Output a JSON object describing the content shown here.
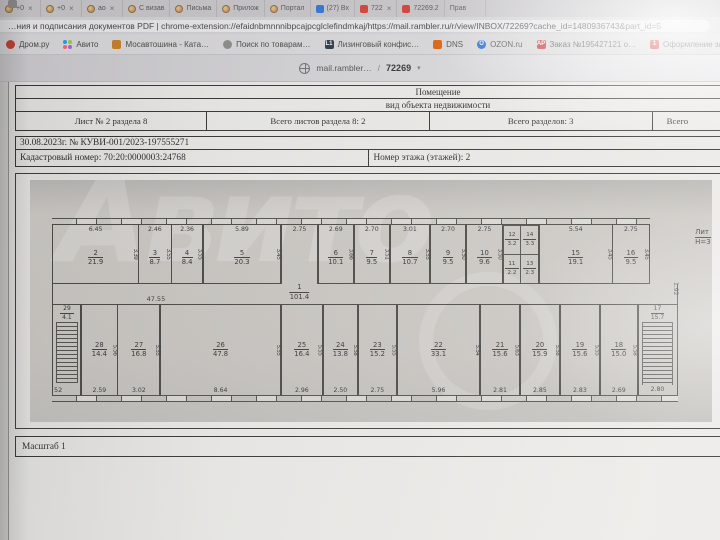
{
  "browser": {
    "tabs": [
      {
        "label": "+0",
        "icon": "rambler",
        "close": true
      },
      {
        "label": "+0",
        "icon": "rambler",
        "close": true
      },
      {
        "label": "ао",
        "icon": "rambler",
        "close": true
      },
      {
        "label": "С визав",
        "icon": "rambler",
        "close": false
      },
      {
        "label": "Письма",
        "icon": "rambler",
        "close": false
      },
      {
        "label": "Прилож",
        "icon": "rambler",
        "close": false
      },
      {
        "label": "Портал",
        "icon": "rambler",
        "close": false
      },
      {
        "label": "(27) Вх",
        "icon": "mail",
        "close": false
      },
      {
        "label": "722",
        "icon": "pdf",
        "close": true
      },
      {
        "label": "72269.2",
        "icon": "pdf",
        "close": false
      },
      {
        "label": "Прав",
        "icon": "doc",
        "close": false
      }
    ],
    "address": "…ния и подписания документов PDF  |  chrome-extension://efaidnbmnnnibpcajpcglclefindmkaj/https://mail.rambler.ru/r/view/INBOX/72269?cache_id=1480936743&part_id=5",
    "bookmarks": [
      {
        "label": "Дром.ру",
        "icon": "circle",
        "color": "#c23b2e",
        "text": ""
      },
      {
        "label": "Авито",
        "icon": "avito",
        "color": "",
        "text": ""
      },
      {
        "label": "Мосавтошина - Ката…",
        "icon": "square",
        "color": "#c87a20",
        "text": ""
      },
      {
        "label": "Поиск по товарам…",
        "icon": "circle",
        "color": "#8a8a88",
        "text": ""
      },
      {
        "label": "Лизинговый конфис…",
        "icon": "text",
        "color": "#243244",
        "text": "L1"
      },
      {
        "label": "DNS",
        "icon": "square",
        "color": "#e05a00",
        "text": ""
      },
      {
        "label": "OZON.ru",
        "icon": "circle",
        "color": "#1464d2",
        "text": "O"
      },
      {
        "label": "Заказ №195427121 о…",
        "icon": "text",
        "color": "#c81f1f",
        "text": "АР"
      },
      {
        "label": "Оформление заказа…",
        "icon": "square",
        "color": "#cf1717",
        "text": "1"
      },
      {
        "label": "14 дней в Европе: м…",
        "icon": "square",
        "color": "#35322f",
        "text": ""
      },
      {
        "label": "Список д…",
        "icon": "square",
        "color": "#c8924a",
        "text": "ссс"
      }
    ],
    "pdf_toolbar": {
      "site": "mail.rambler…",
      "slash": "/",
      "page": "72269",
      "caret": "▾"
    }
  },
  "document": {
    "title": "Помещение",
    "subtitle": "вид объекта недвижимости",
    "header_cells": [
      "Лист № 2 раздела 8",
      "Всего листов раздела 8: 2",
      "Всего разделов: 3",
      "Всего"
    ],
    "date_line": "30.08.2023г. № КУВИ-001/2023-197555271",
    "cadastral": "Кадастровый номер: 70:20:0000003:24768",
    "floor": "Номер этажа (этажей): 2",
    "scale": "Масштаб 1"
  },
  "plan": {
    "liter": "Лит",
    "height_note": "Н=3",
    "watermark": "Авито",
    "corridor": {
      "num": "1",
      "area": "101.4",
      "length": "47.55"
    },
    "top_band": [
      {
        "type": "room",
        "num": "2",
        "area": "21.9",
        "dim": "6.45",
        "w": 6.45,
        "side": "3.39"
      },
      {
        "type": "room",
        "num": "3",
        "area": "8.7",
        "dim": "2.46",
        "w": 2.46,
        "side": "3.55"
      },
      {
        "type": "room",
        "num": "4",
        "area": "8.4",
        "dim": "2.36",
        "w": 2.36,
        "side": "3.55"
      },
      {
        "type": "room",
        "num": "5",
        "area": "20.3",
        "dim": "5.89",
        "w": 5.89,
        "side": "3.45"
      },
      {
        "type": "gap",
        "dim": "2.75",
        "w": 2.75
      },
      {
        "type": "room",
        "num": "6",
        "area": "10.1",
        "dim": "2.69",
        "w": 2.69,
        "side": "3.66"
      },
      {
        "type": "room",
        "num": "7",
        "area": "9.5",
        "dim": "2.70",
        "w": 2.7,
        "side": "3.51"
      },
      {
        "type": "room",
        "num": "8",
        "area": "10.7",
        "dim": "3.01",
        "w": 3.01,
        "side": "3.55"
      },
      {
        "type": "room",
        "num": "9",
        "area": "9.5",
        "dim": "2.70",
        "w": 2.7,
        "side": "3.50"
      },
      {
        "type": "room",
        "num": "10",
        "area": "9.6",
        "dim": "2.75",
        "w": 2.75,
        "side": "3.50"
      },
      {
        "type": "wc",
        "w": 2.7,
        "cells": [
          [
            "12",
            "3.2"
          ],
          [
            "14",
            "3.3"
          ],
          [
            "11",
            "2.2"
          ],
          [
            "13",
            "2.3"
          ]
        ]
      },
      {
        "type": "room",
        "num": "15",
        "area": "19.1",
        "dim": "5.54",
        "w": 5.54,
        "side": "3.45"
      },
      {
        "type": "room",
        "num": "16",
        "area": "9.5",
        "dim": "2.75",
        "w": 2.75,
        "side": "3.45"
      }
    ],
    "bottom_band": [
      {
        "type": "stairs-left",
        "w": 2.0,
        "num": "29",
        "area": "4.1",
        "label": "52"
      },
      {
        "type": "room",
        "num": "28",
        "area": "14.4",
        "dim": "2.59",
        "w": 2.59,
        "side": "5.56"
      },
      {
        "type": "room",
        "num": "27",
        "area": "16.8",
        "dim": "3.02",
        "w": 3.02,
        "side": "5.55"
      },
      {
        "type": "room",
        "num": "26",
        "area": "47.8",
        "dim": "8.64",
        "w": 8.64,
        "side": "5.55"
      },
      {
        "type": "room",
        "num": "25",
        "area": "16.4",
        "dim": "2.96",
        "w": 2.96,
        "side": "5.55"
      },
      {
        "type": "room",
        "num": "24",
        "area": "13.8",
        "dim": "2.50",
        "w": 2.5,
        "side": "5.58"
      },
      {
        "type": "room",
        "num": "23",
        "area": "15.2",
        "dim": "2.75",
        "w": 2.75,
        "side": "5.55"
      },
      {
        "type": "room",
        "num": "22",
        "area": "33.1",
        "dim": "5.96",
        "w": 5.96,
        "side": "5.54"
      },
      {
        "type": "room",
        "num": "21",
        "area": "15.6",
        "dim": "2.81",
        "w": 2.81,
        "side": "5.63"
      },
      {
        "type": "room",
        "num": "20",
        "area": "15.9",
        "dim": "2.85",
        "w": 2.85,
        "side": "5.58"
      },
      {
        "type": "room",
        "num": "19",
        "area": "15.6",
        "dim": "2.83",
        "w": 2.83,
        "side": "5.55"
      },
      {
        "type": "room",
        "num": "18",
        "area": "15.0",
        "dim": "2.69",
        "w": 2.69,
        "side": "5.58"
      },
      {
        "type": "stairs-right",
        "w": 2.8,
        "num": "17",
        "area": "15.7",
        "dim": "2.80",
        "gap": "1.92"
      }
    ]
  }
}
